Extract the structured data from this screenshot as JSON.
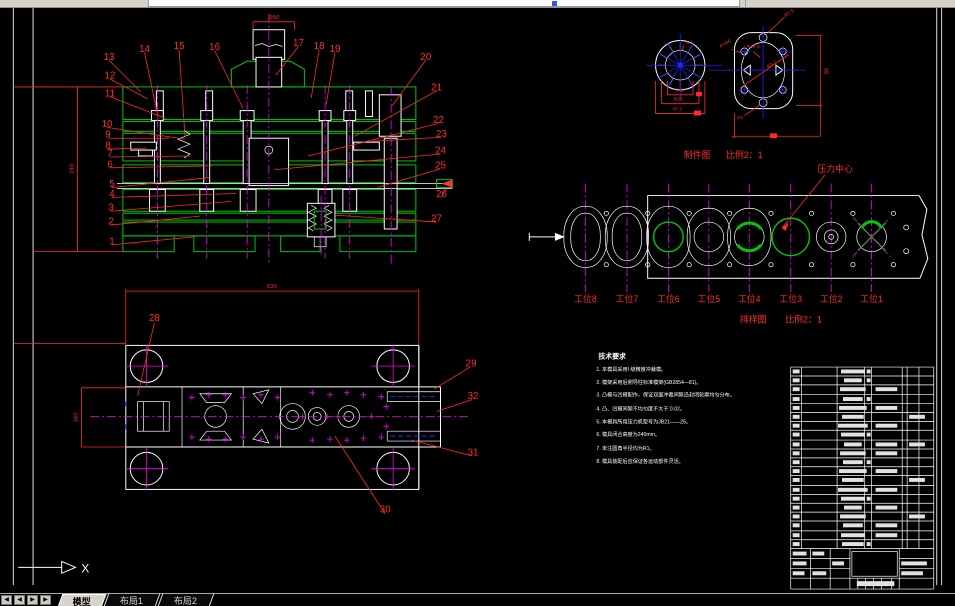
{
  "window": {
    "tabs": {
      "model": "模型",
      "layout1": "布局1",
      "layout2": "布局2"
    },
    "nav": [
      "◀",
      "◀",
      "▶",
      "▶"
    ]
  },
  "drawing": {
    "section": {
      "balloons": [
        "1",
        "2",
        "3",
        "4",
        "5",
        "6",
        "7",
        "8",
        "9",
        "10",
        "11",
        "12",
        "13",
        "14",
        "15",
        "16",
        "17",
        "18",
        "19",
        "20",
        "21",
        "22",
        "23",
        "24",
        "25",
        "26",
        "27"
      ],
      "dim_height": "240",
      "dim_shank": "Φ50"
    },
    "plan": {
      "balloons": [
        "28",
        "29",
        "30",
        "31",
        "32"
      ],
      "dim_width": "630",
      "dim_side": "160"
    },
    "parts": {
      "title": "制件图",
      "scale": "比例2：1",
      "dims": {
        "top": "Φ4",
        "d1": "Φ32",
        "d2": "R26",
        "d3": "47.2",
        "holes": "4×Φ6",
        "r_top": "R14.5",
        "dia": "Φ4.2",
        "r_bottom": "R1",
        "height": "56",
        "r_corner": "R2.5"
      }
    },
    "strip": {
      "title": "排样图",
      "scale": "比例2：1",
      "pressure_center": "压力中心",
      "stations": [
        "工位8",
        "工位7",
        "工位6",
        "工位5",
        "工位4",
        "工位3",
        "工位2",
        "工位1"
      ]
    },
    "notes": {
      "title": "技术要求",
      "lines": [
        "1. 本模具采用I 级精度冲裁模。",
        "2. 模架采用后侧导柱标准模架(GB2854—81)。",
        "3. 凸模与凹模配作，保证双面冲裁间隙沿封闭轮廓均匀分布。",
        "4. 凸、凹模间隙不均匀度不大于 0.02。",
        "5. 本模具所用压力机型号为JB21——25。",
        "6. 模具闭合高度为240mm。",
        "7. 未注圆角半径均为R1。",
        "8. 模具装配后应保证各运动部件灵活。"
      ]
    },
    "ucs_x": "X"
  }
}
